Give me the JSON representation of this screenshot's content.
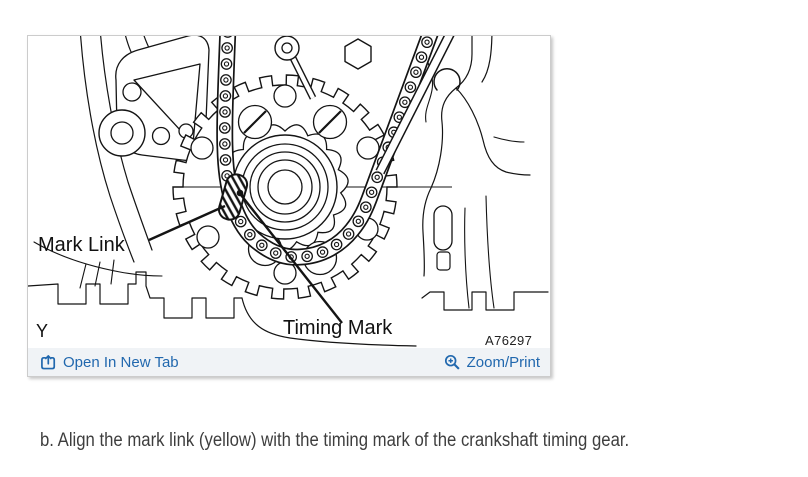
{
  "figure_panel": {
    "diagram": {
      "labels": {
        "mark_link": "Mark Link",
        "timing_mark": "Timing Mark"
      },
      "view_letter": "Y",
      "figure_code": "A76297"
    },
    "toolbar": {
      "open_in_new_tab_label": "Open In New Tab",
      "zoom_print_label": "Zoom/Print",
      "icons": {
        "open_in_new_tab": "open-in-new-tab-icon",
        "zoom_print": "magnifier-plus-icon"
      }
    }
  },
  "caption": {
    "step_text": "b. Align the mark link (yellow) with the timing mark of the crankshaft timing gear."
  },
  "colors": {
    "link_blue": "#2168ae",
    "toolbar_bg": "#f0f3f6",
    "panel_border": "#cccccc",
    "diagram_line": "#141414",
    "caption_text": "#3e3e3e"
  }
}
